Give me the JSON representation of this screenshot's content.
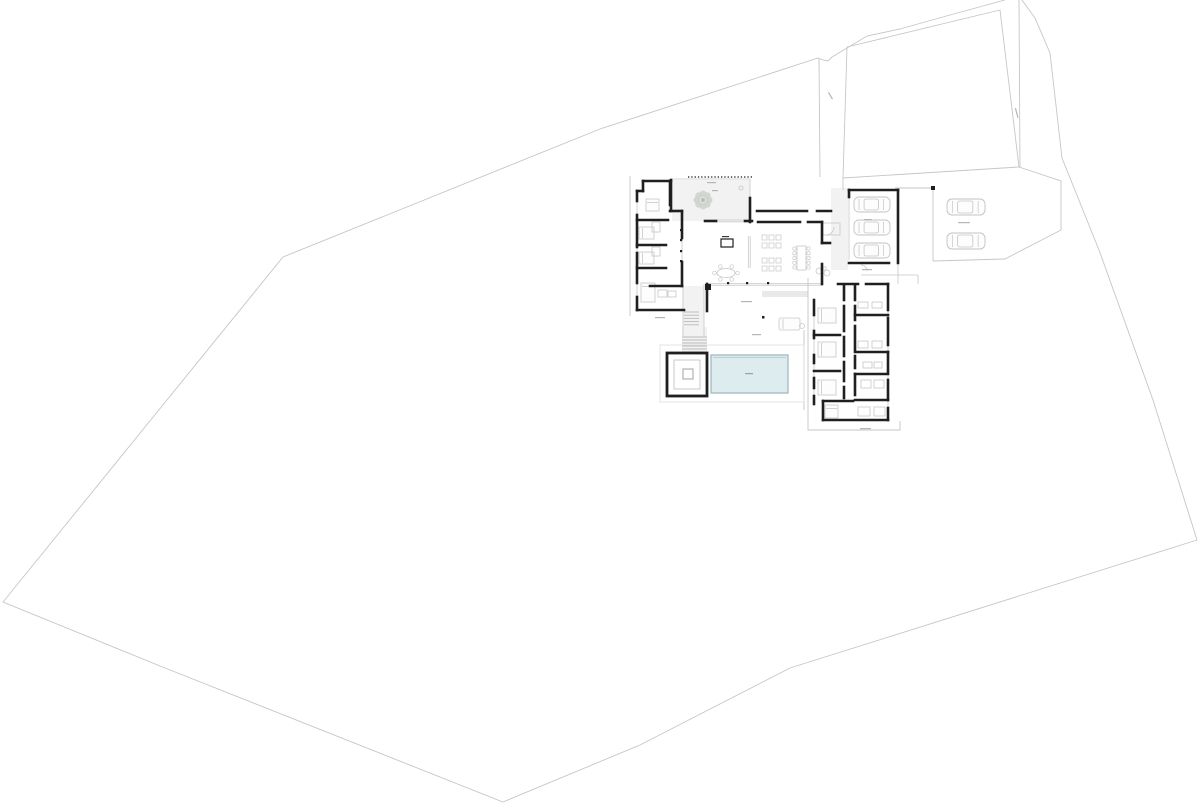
{
  "summary": {
    "drawing_kind": "architectural site and floor plan",
    "garage_cars": 3,
    "visitor_cars": 2,
    "bedrooms_left_wing": 4,
    "bedrooms_right_wing": 4,
    "pools": 1,
    "spas": 1,
    "courtyard_trees": 1
  },
  "drawing": {
    "width": 1200,
    "height": 806,
    "colors": {
      "background": "#ffffff",
      "wall": "#1f1f1f",
      "site": "#c6c6c6",
      "thin": "#c7c7c7",
      "furniture": "#c6c6c6",
      "paving": "#f2f2f2",
      "pool_fill": "#dcecef",
      "pool_border": "#9db3bb",
      "pool_inner": "#afc6cc",
      "dash": "#b5b5b5",
      "tree": "#ccd2cc",
      "car": "#c3c3c3"
    },
    "site_paths": [
      "M1005,0 L950,15 L900,29 L867,36 L832,57 L828,61 L823,60 L818,58 L600,129 L283,257 L3,602 L160,666 L503,802 L640,745 L790,668 L1197,540 L1153,400 L1099,250 L1062,158 L1050,53 L1035,18 L1022,0",
      "M1019,0 L1020,168",
      "M847,47 L1000,10 L1019,167 L843,178 Z",
      "M819,58 L820,177",
      "M1019,167 L1061,181 L1061,230 L1005,259 L933,261",
      "M933,188 L933,261",
      "M895,188 L933,188",
      "M843,178 L843,190",
      "M808,278 L808,430 L900,430 L900,421",
      "M630,176 L630,316",
      "M804,330 L804,410"
    ],
    "pavings": [
      [
        672,
        180,
        78,
        41
      ],
      [
        831,
        188,
        17,
        82
      ],
      [
        683,
        286,
        21,
        50
      ],
      [
        682,
        327,
        25,
        26
      ],
      [
        762,
        291,
        46,
        6,
        "#e9e9e9"
      ]
    ],
    "thin_lines": [
      [
        637,
        191,
        637,
        310
      ],
      [
        814,
        300,
        814,
        404
      ],
      [
        888,
        284,
        888,
        420
      ],
      [
        706,
        283.4,
        822,
        283.4
      ],
      [
        706,
        285.2,
        822,
        285.2
      ],
      [
        716,
        220,
        745,
        220
      ],
      [
        716,
        221.8,
        745,
        221.8
      ],
      [
        671,
        179,
        750,
        179
      ],
      [
        750,
        179,
        750,
        221
      ],
      [
        748.3,
        236,
        748.3,
        268
      ],
      [
        750.2,
        236,
        750.2,
        268
      ],
      [
        682,
        238,
        682,
        262
      ],
      [
        849,
        197,
        849,
        260
      ],
      [
        861,
        275,
        918,
        275
      ],
      [
        918,
        275,
        918,
        284
      ],
      [
        898,
        263,
        898,
        284
      ],
      [
        683,
        284,
        683,
        336
      ],
      [
        704,
        284,
        704,
        336
      ]
    ],
    "thin_rects": [
      [
        660,
        345,
        144,
        57,
        "#dcdcdc"
      ],
      [
        823,
        223,
        17,
        12,
        "#c7c7c7"
      ]
    ],
    "arcs": [
      "M826,235 A8,8 0 0 0 834,227",
      "M861,265 A6,6 0 0 1 867,271"
    ],
    "canopy": {
      "x1": 688,
      "y1": 177,
      "x2": 752,
      "y2": 177
    },
    "steps": [
      {
        "x": 684,
        "y": 312,
        "w": 15,
        "count": 5,
        "gap": 3.2
      },
      {
        "x": 682,
        "y": 337,
        "w": 25,
        "count": 6,
        "gap": 3
      }
    ],
    "walls": [
      [
        643,
        181,
        671,
        181
      ],
      [
        643,
        181,
        643,
        191
      ],
      [
        637,
        191,
        643,
        191
      ],
      [
        637,
        191,
        637,
        201
      ],
      [
        637,
        215,
        637,
        247
      ],
      [
        637,
        253,
        637,
        283
      ],
      [
        637,
        297,
        637,
        310
      ],
      [
        637,
        310,
        684,
        310
      ],
      [
        637,
        220,
        668,
        220
      ],
      [
        637,
        245,
        666,
        245
      ],
      [
        637,
        268,
        666,
        268
      ],
      [
        650,
        286,
        682,
        286
      ],
      [
        670,
        181,
        670,
        205
      ],
      [
        670,
        211,
        682,
        211
      ],
      [
        682,
        211,
        682,
        238
      ],
      [
        682,
        262,
        682,
        286
      ],
      [
        671,
        180,
        671,
        211
      ],
      [
        705,
        221,
        716,
        221
      ],
      [
        745,
        221,
        752,
        221
      ],
      [
        757,
        211,
        807,
        211
      ],
      [
        817,
        211,
        831,
        211
      ],
      [
        758,
        222,
        800,
        222
      ],
      [
        808,
        222,
        822,
        222
      ],
      [
        750,
        198,
        750,
        222
      ],
      [
        822,
        222,
        822,
        243
      ],
      [
        822,
        243,
        830,
        243
      ],
      [
        822,
        264,
        822,
        284
      ],
      [
        707,
        284,
        707,
        311
      ],
      [
        849,
        190,
        898,
        190
      ],
      [
        898,
        190,
        898,
        263
      ],
      [
        849,
        263,
        889,
        263
      ],
      [
        849,
        190,
        849,
        197
      ],
      [
        838,
        284,
        858,
        284
      ],
      [
        866,
        284,
        888,
        284
      ],
      [
        814,
        300,
        814,
        315
      ],
      [
        814,
        331,
        814,
        338
      ],
      [
        814,
        355,
        814,
        363
      ],
      [
        814,
        378,
        814,
        388
      ],
      [
        814,
        396,
        814,
        404
      ],
      [
        844,
        285,
        844,
        300
      ],
      [
        844,
        306,
        844,
        331
      ],
      [
        844,
        337,
        844,
        356
      ],
      [
        844,
        362,
        844,
        381
      ],
      [
        844,
        387,
        844,
        398
      ],
      [
        855,
        285,
        855,
        300
      ],
      [
        855,
        306,
        855,
        320
      ],
      [
        855,
        326,
        855,
        350
      ],
      [
        855,
        356,
        855,
        368
      ],
      [
        855,
        374,
        855,
        395
      ],
      [
        888,
        284,
        888,
        310
      ],
      [
        888,
        318,
        888,
        345
      ],
      [
        888,
        352,
        888,
        372
      ],
      [
        888,
        380,
        888,
        400
      ],
      [
        888,
        408,
        888,
        420
      ],
      [
        814,
        335,
        840,
        335
      ],
      [
        814,
        371,
        840,
        371
      ],
      [
        823,
        401,
        853,
        401
      ],
      [
        823,
        401,
        823,
        420
      ],
      [
        855,
        315,
        888,
        315
      ],
      [
        855,
        352,
        888,
        352
      ],
      [
        855,
        374,
        888,
        374
      ],
      [
        855,
        400,
        888,
        400
      ],
      [
        823,
        420,
        888,
        420
      ]
    ],
    "lift_box": [
      721,
      239,
      12,
      8
    ],
    "spa": {
      "outer": [
        667,
        353,
        40,
        43
      ],
      "inner": [
        674,
        360,
        26,
        29
      ],
      "glyph": [
        683,
        369,
        10,
        10
      ]
    },
    "pool": {
      "x": 711,
      "y": 355,
      "w": 77,
      "h": 38
    },
    "tree": {
      "cx": 703,
      "cy": 200,
      "r": 6,
      "petal_r": 3.5,
      "petals": 8
    },
    "small_circle": [
      741,
      188,
      2
    ],
    "beds": [
      [
        646,
        199,
        13,
        12,
        "top"
      ],
      [
        639,
        227,
        15,
        12,
        "left"
      ],
      [
        639,
        252,
        15,
        12,
        "left"
      ],
      [
        641,
        283,
        14,
        19,
        "top"
      ],
      [
        818,
        308,
        18,
        15,
        "left"
      ],
      [
        818,
        342,
        18,
        15,
        "left"
      ],
      [
        818,
        380,
        18,
        15,
        "left"
      ],
      [
        825,
        405,
        13,
        13,
        "top"
      ]
    ],
    "fixtures": [
      [
        858,
        302,
        10,
        6
      ],
      [
        872,
        302,
        10,
        6
      ],
      [
        858,
        341,
        10,
        7
      ],
      [
        872,
        341,
        10,
        7
      ],
      [
        863,
        362,
        9,
        6
      ],
      [
        874,
        362,
        8,
        6
      ],
      [
        861,
        380,
        10,
        8
      ],
      [
        874,
        380,
        10,
        8
      ],
      [
        858,
        407,
        12,
        9
      ],
      [
        874,
        407,
        11,
        9
      ],
      [
        658,
        290,
        9,
        7
      ],
      [
        668,
        291,
        8,
        6
      ],
      [
        652,
        222,
        8,
        10
      ],
      [
        652,
        247,
        8,
        9
      ]
    ],
    "dining_long": {
      "x": 797,
      "y": 246,
      "w": 9,
      "h": 24,
      "chairs_per_side": 5
    },
    "dining_round": {
      "cx": 726,
      "cy": 273,
      "rx": 9,
      "ry": 4.5,
      "seats": 6
    },
    "lounge_squares": [
      [
        762,
        235
      ],
      [
        769,
        235
      ],
      [
        776,
        235
      ],
      [
        762,
        243
      ],
      [
        769,
        243
      ],
      [
        776,
        243
      ],
      [
        762,
        258
      ],
      [
        769,
        258
      ],
      [
        776,
        258
      ],
      [
        762,
        266
      ],
      [
        769,
        266
      ],
      [
        776,
        266
      ]
    ],
    "lounge_square_size": 5,
    "lounge_entry": {
      "circles": [
        [
          819,
          271,
          3
        ],
        [
          827,
          273,
          3
        ]
      ],
      "table": [
        822,
        267,
        4,
        3
      ]
    },
    "daybed": {
      "x": 779,
      "y": 318,
      "w": 21,
      "h": 12,
      "side_table": [
        802,
        326,
        2.5
      ]
    },
    "garage_cars": [
      [
        854,
        197,
        36,
        15
      ],
      [
        854,
        220,
        36,
        15
      ],
      [
        854,
        243,
        36,
        15
      ]
    ],
    "visitor_cars": [
      [
        947,
        199,
        38,
        16
      ],
      [
        947,
        233,
        38,
        16
      ]
    ],
    "columns": [
      [
        680,
        229
      ],
      [
        680,
        239
      ],
      [
        680,
        250
      ],
      [
        680,
        260
      ],
      [
        727,
        282
      ],
      [
        746,
        282
      ],
      [
        767,
        282
      ]
    ],
    "column_size": 2.2,
    "dots": [
      [
        931,
        186,
        4
      ],
      [
        762,
        316,
        2.5
      ],
      [
        705,
        284,
        6
      ]
    ],
    "dashes": [
      {
        "x": 707,
        "y": 182,
        "len": 9
      },
      {
        "x": 722,
        "y": 236,
        "len": 7,
        "color": "#3a3a3a"
      },
      {
        "x": 655,
        "y": 317,
        "len": 10
      },
      {
        "x": 741,
        "y": 301,
        "len": 11
      },
      {
        "x": 752,
        "y": 334,
        "len": 9
      },
      {
        "x": 745,
        "y": 373,
        "len": 8,
        "color": "#8fa6ad"
      },
      {
        "x": 864,
        "y": 219,
        "len": 8
      },
      {
        "x": 862,
        "y": 269,
        "len": 10
      },
      {
        "x": 958,
        "y": 222,
        "len": 12
      },
      {
        "x": 860,
        "y": 428,
        "len": 11
      },
      {
        "x": 1016,
        "y": 108,
        "len": 10,
        "rot": 75
      },
      {
        "x": 829,
        "y": 92,
        "len": 8,
        "rot": 60
      },
      {
        "x": 712,
        "y": 190,
        "len": 6
      }
    ]
  }
}
